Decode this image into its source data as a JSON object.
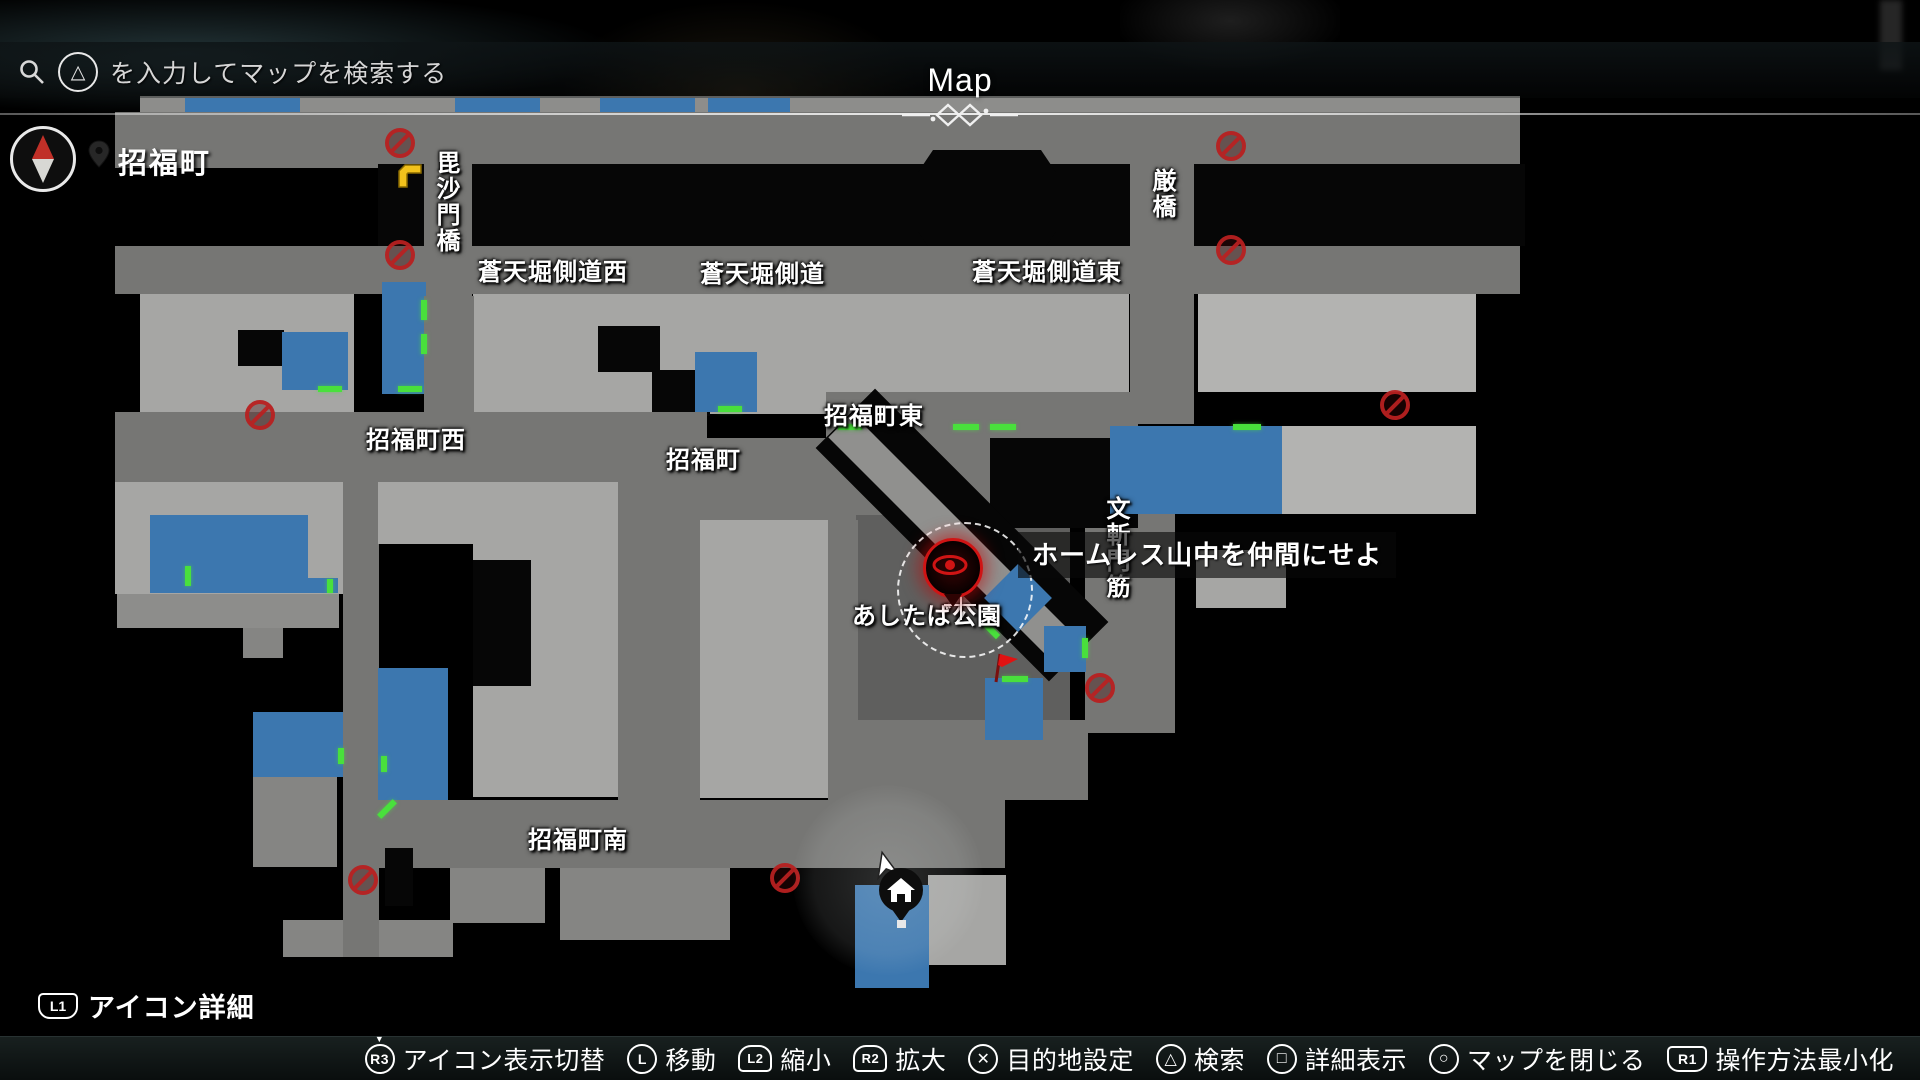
{
  "header": {
    "title": "Map",
    "search": {
      "button_glyph": "△",
      "placeholder": "を入力してマップを検索する"
    },
    "location": "招福町"
  },
  "hint_left": {
    "button": "L1",
    "label": "アイコン詳細"
  },
  "controls": [
    {
      "button": "R3",
      "type": "stick-press",
      "label": "アイコン表示切替"
    },
    {
      "button": "L",
      "type": "stick",
      "label": "移動"
    },
    {
      "button": "L2",
      "type": "trigger",
      "label": "縮小"
    },
    {
      "button": "R2",
      "type": "trigger",
      "label": "拡大"
    },
    {
      "button": "cross",
      "type": "face",
      "label": "目的地設定"
    },
    {
      "button": "triangle",
      "type": "face",
      "label": "検索"
    },
    {
      "button": "square",
      "type": "face",
      "label": "詳細表示"
    },
    {
      "button": "circle",
      "type": "face",
      "label": "マップを閉じる"
    },
    {
      "button": "R1",
      "type": "shoulder",
      "label": "操作方法最小化"
    }
  ],
  "map": {
    "colors": {
      "shop_blue": "#3c77af",
      "entrance_green": "#49e03c",
      "no_entry_red": "#b82020",
      "destination_red": "#cf1414",
      "flag_red": "#e01212",
      "taxi_yellow": "#f2c21c",
      "road_gray": "#767674",
      "building_gray": "#a6a6a4"
    },
    "quest": {
      "text": "ホームレス山中を仲間にせよ",
      "x": 1018,
      "y": 532
    },
    "labels": [
      {
        "text": "毘沙門橋",
        "x": 428,
        "y": 150,
        "vertical": true
      },
      {
        "text": "蒼天堀側道西",
        "x": 478,
        "y": 252
      },
      {
        "text": "蒼天堀側道",
        "x": 700,
        "y": 254
      },
      {
        "text": "蒼天堀側道東",
        "x": 972,
        "y": 252
      },
      {
        "text": "厳橋",
        "x": 1144,
        "y": 168,
        "vertical": true
      },
      {
        "text": "招福町西",
        "x": 366,
        "y": 420
      },
      {
        "text": "招福町",
        "x": 666,
        "y": 440
      },
      {
        "text": "招福町東",
        "x": 824,
        "y": 396
      },
      {
        "text": "文斬門筋",
        "x": 1098,
        "y": 496,
        "vertical": true
      },
      {
        "text": "あしたば公園",
        "x": 852,
        "y": 596
      },
      {
        "text": "招福町南",
        "x": 528,
        "y": 820
      }
    ],
    "shapes": [
      {
        "x": 140,
        "y": 96,
        "w": 1380,
        "h": 18,
        "c": "slate"
      },
      {
        "x": 185,
        "y": 98,
        "w": 115,
        "h": 15,
        "c": "shop"
      },
      {
        "x": 455,
        "y": 98,
        "w": 85,
        "h": 15,
        "c": "shop"
      },
      {
        "x": 600,
        "y": 98,
        "w": 95,
        "h": 15,
        "c": "shop"
      },
      {
        "x": 708,
        "y": 98,
        "w": 82,
        "h": 15,
        "c": "shop"
      },
      {
        "x": 115,
        "y": 112,
        "w": 1405,
        "h": 56,
        "c": "road"
      },
      {
        "x": 378,
        "y": 164,
        "w": 1147,
        "h": 82,
        "c": "black"
      },
      {
        "x": 912,
        "y": 150,
        "w": 150,
        "h": 104,
        "c": "black",
        "octa": true
      },
      {
        "x": 424,
        "y": 112,
        "w": 48,
        "h": 184,
        "c": "road"
      },
      {
        "x": 1130,
        "y": 112,
        "w": 64,
        "h": 184,
        "c": "road"
      },
      {
        "x": 115,
        "y": 246,
        "w": 1405,
        "h": 48,
        "c": "road"
      },
      {
        "x": 140,
        "y": 294,
        "w": 214,
        "h": 118,
        "c": "bldg"
      },
      {
        "x": 238,
        "y": 330,
        "w": 46,
        "h": 36,
        "c": "black"
      },
      {
        "x": 382,
        "y": 282,
        "w": 44,
        "h": 112,
        "c": "shop"
      },
      {
        "x": 473,
        "y": 294,
        "w": 656,
        "h": 120,
        "c": "bldg"
      },
      {
        "x": 598,
        "y": 326,
        "w": 62,
        "h": 46,
        "c": "black"
      },
      {
        "x": 652,
        "y": 370,
        "w": 58,
        "h": 46,
        "c": "black"
      },
      {
        "x": 695,
        "y": 352,
        "w": 62,
        "h": 60,
        "c": "shop"
      },
      {
        "x": 1198,
        "y": 294,
        "w": 278,
        "h": 98,
        "c": "bldg2"
      },
      {
        "x": 1130,
        "y": 296,
        "w": 64,
        "h": 128,
        "c": "road"
      },
      {
        "x": 424,
        "y": 296,
        "w": 50,
        "h": 120,
        "c": "road"
      },
      {
        "x": 282,
        "y": 332,
        "w": 66,
        "h": 58,
        "c": "shop"
      },
      {
        "x": 115,
        "y": 412,
        "w": 592,
        "h": 70,
        "c": "road"
      },
      {
        "x": 640,
        "y": 438,
        "w": 500,
        "h": 82,
        "c": "road"
      },
      {
        "x": 826,
        "y": 392,
        "w": 312,
        "h": 46,
        "c": "road"
      },
      {
        "x": 1085,
        "y": 438,
        "w": 90,
        "h": 295,
        "c": "road"
      },
      {
        "x": 856,
        "y": 515,
        "w": 214,
        "h": 207,
        "c": "park"
      },
      {
        "x": 990,
        "y": 438,
        "w": 148,
        "h": 90,
        "c": "black"
      },
      {
        "x": 920,
        "y": 370,
        "w": 84,
        "h": 330,
        "c": "black",
        "r": -45
      },
      {
        "x": 933,
        "y": 380,
        "w": 34,
        "h": 310,
        "c": "stripe",
        "r": -45
      },
      {
        "x": 994,
        "y": 574,
        "w": 48,
        "h": 48,
        "c": "shop",
        "r": 45
      },
      {
        "x": 1110,
        "y": 426,
        "w": 172,
        "h": 88,
        "c": "shop"
      },
      {
        "x": 1282,
        "y": 426,
        "w": 194,
        "h": 88,
        "c": "bldg2"
      },
      {
        "x": 1196,
        "y": 550,
        "w": 90,
        "h": 58,
        "c": "bldg"
      },
      {
        "x": 1044,
        "y": 626,
        "w": 42,
        "h": 46,
        "c": "shop"
      },
      {
        "x": 115,
        "y": 482,
        "w": 230,
        "h": 112,
        "c": "bldg"
      },
      {
        "x": 150,
        "y": 515,
        "w": 158,
        "h": 78,
        "c": "shop"
      },
      {
        "x": 306,
        "y": 578,
        "w": 32,
        "h": 15,
        "c": "shop"
      },
      {
        "x": 117,
        "y": 594,
        "w": 222,
        "h": 34,
        "c": "slate"
      },
      {
        "x": 243,
        "y": 628,
        "w": 40,
        "h": 30,
        "c": "bldgd"
      },
      {
        "x": 253,
        "y": 712,
        "w": 90,
        "h": 65,
        "c": "shop"
      },
      {
        "x": 253,
        "y": 777,
        "w": 84,
        "h": 90,
        "c": "bldgd"
      },
      {
        "x": 283,
        "y": 920,
        "w": 170,
        "h": 37,
        "c": "bldgd"
      },
      {
        "x": 343,
        "y": 482,
        "w": 36,
        "h": 475,
        "c": "road"
      },
      {
        "x": 378,
        "y": 482,
        "w": 96,
        "h": 62,
        "c": "bldg"
      },
      {
        "x": 378,
        "y": 668,
        "w": 70,
        "h": 142,
        "c": "shop"
      },
      {
        "x": 473,
        "y": 482,
        "w": 146,
        "h": 315,
        "c": "bldg"
      },
      {
        "x": 473,
        "y": 560,
        "w": 58,
        "h": 126,
        "c": "black"
      },
      {
        "x": 618,
        "y": 482,
        "w": 82,
        "h": 318,
        "c": "road"
      },
      {
        "x": 700,
        "y": 520,
        "w": 128,
        "h": 278,
        "c": "bldg"
      },
      {
        "x": 828,
        "y": 520,
        "w": 30,
        "h": 280,
        "c": "road"
      },
      {
        "x": 858,
        "y": 720,
        "w": 230,
        "h": 80,
        "c": "road"
      },
      {
        "x": 343,
        "y": 800,
        "w": 662,
        "h": 68,
        "c": "road"
      },
      {
        "x": 385,
        "y": 848,
        "w": 28,
        "h": 58,
        "c": "black"
      },
      {
        "x": 450,
        "y": 868,
        "w": 95,
        "h": 55,
        "c": "bldgd"
      },
      {
        "x": 560,
        "y": 868,
        "w": 170,
        "h": 72,
        "c": "bldgd"
      },
      {
        "x": 928,
        "y": 875,
        "w": 78,
        "h": 90,
        "c": "bldg"
      },
      {
        "x": 985,
        "y": 678,
        "w": 58,
        "h": 62,
        "c": "shop"
      },
      {
        "x": 855,
        "y": 885,
        "w": 74,
        "h": 103,
        "c": "shop"
      }
    ],
    "entrances": [
      {
        "x": 421,
        "y": 300,
        "w": 6,
        "h": 20
      },
      {
        "x": 421,
        "y": 334,
        "w": 6,
        "h": 20
      },
      {
        "x": 398,
        "y": 386,
        "w": 24,
        "h": 6
      },
      {
        "x": 318,
        "y": 386,
        "w": 24,
        "h": 6
      },
      {
        "x": 185,
        "y": 566,
        "w": 6,
        "h": 20
      },
      {
        "x": 327,
        "y": 579,
        "w": 6,
        "h": 14
      },
      {
        "x": 718,
        "y": 406,
        "w": 24,
        "h": 6
      },
      {
        "x": 838,
        "y": 424,
        "w": 24,
        "h": 6
      },
      {
        "x": 953,
        "y": 424,
        "w": 26,
        "h": 6
      },
      {
        "x": 990,
        "y": 424,
        "w": 26,
        "h": 6
      },
      {
        "x": 1233,
        "y": 424,
        "w": 28,
        "h": 6
      },
      {
        "x": 1002,
        "y": 676,
        "w": 26,
        "h": 6
      },
      {
        "x": 988,
        "y": 620,
        "w": 6,
        "h": 20,
        "r": -45
      },
      {
        "x": 1082,
        "y": 638,
        "w": 6,
        "h": 20
      },
      {
        "x": 338,
        "y": 748,
        "w": 6,
        "h": 16
      },
      {
        "x": 381,
        "y": 756,
        "w": 6,
        "h": 16
      },
      {
        "x": 384,
        "y": 798,
        "w": 6,
        "h": 22,
        "r": 45
      }
    ],
    "no_entry": [
      {
        "x": 400,
        "y": 143
      },
      {
        "x": 400,
        "y": 255
      },
      {
        "x": 1231,
        "y": 146
      },
      {
        "x": 1231,
        "y": 250
      },
      {
        "x": 260,
        "y": 415
      },
      {
        "x": 1395,
        "y": 405
      },
      {
        "x": 1100,
        "y": 688
      },
      {
        "x": 785,
        "y": 878
      },
      {
        "x": 363,
        "y": 880
      }
    ],
    "markers": {
      "destination": {
        "x": 953,
        "y": 568,
        "ring_x": 965,
        "ring_y": 590
      },
      "crosshair": {
        "x": 960,
        "y": 604
      },
      "flag": {
        "x": 1003,
        "y": 666
      },
      "player_home": {
        "x": 893,
        "y": 898,
        "glow_x": 888,
        "glow_y": 880
      },
      "taxi": {
        "x": 410,
        "y": 176
      }
    }
  }
}
